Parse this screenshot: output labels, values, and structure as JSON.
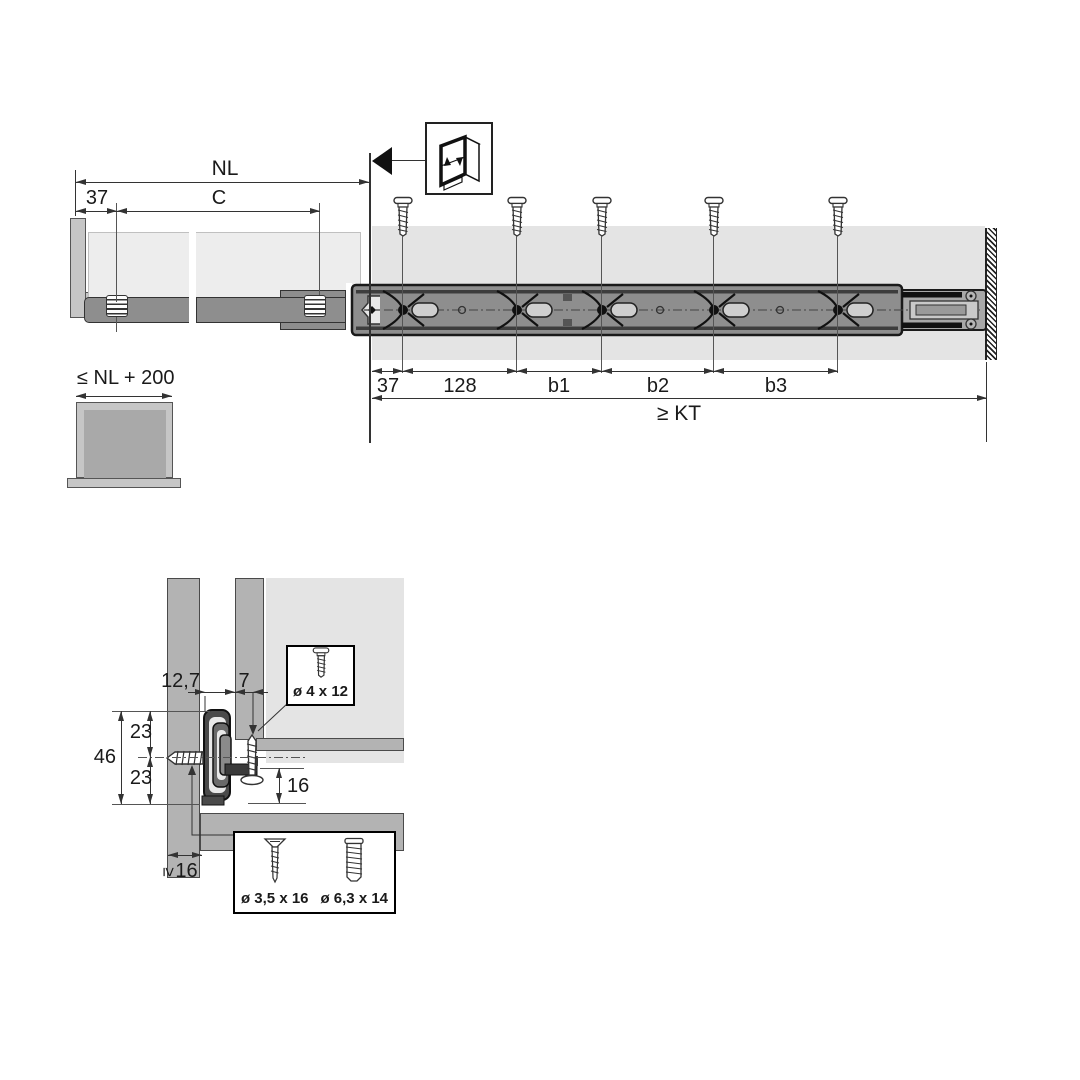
{
  "figure": {
    "top_view": {
      "nl": "NL",
      "front_offset": "37",
      "c": "C",
      "seg_37": "37",
      "seg_128": "128",
      "seg_b1": "b1",
      "seg_b2": "b2",
      "seg_b3": "b3",
      "kt": "≥ KT"
    },
    "drawer_box": {
      "max_length": "≤ NL + 200"
    },
    "cross_section": {
      "offset_12_7": "12,7",
      "offset_7": "7",
      "dim_23_top": "23",
      "dim_46": "46",
      "dim_23_bottom": "23",
      "dim_16": "16",
      "min_thickness_symbol": "≥",
      "min_thickness_value": "16",
      "screw_top": "ø 4 x 12",
      "screw_bottom_left": "ø 3,5 x 16",
      "screw_bottom_right": "ø 6,3 x 14"
    }
  }
}
